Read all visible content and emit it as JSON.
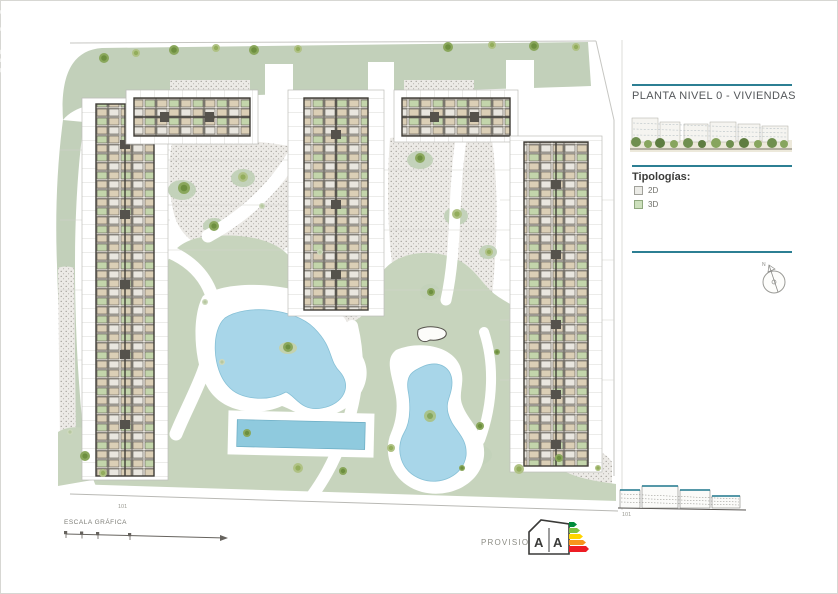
{
  "watermark": {
    "line1": "draco",
    "line2": "ea"
  },
  "panel": {
    "title": "PLANTA NIVEL 0 - VIVIENDAS",
    "legend_heading": "Tipologías:",
    "legend_items": [
      {
        "label": "2D",
        "swatch_color": "#ebebe6"
      },
      {
        "label": "3D",
        "swatch_color": "#cde0bd"
      }
    ],
    "rule_color": "#2c7f93"
  },
  "compass": {
    "label": "N"
  },
  "footer": {
    "scale_label": "ESCALA GRÁFICA",
    "left_note": "101",
    "provisional_label": "PROVISIONAL",
    "elevation_note": "101"
  },
  "energy_label": {
    "letters": [
      "A",
      "A"
    ],
    "arrow_colors": [
      "#008c3c",
      "#7fc241",
      "#ffd500",
      "#f7941d",
      "#ed1c24"
    ]
  },
  "plan_colors": {
    "lawn": "#c7d4bd",
    "top_band": "#c2d0ba",
    "stipple_base": "#eceae6",
    "stipple_dot": "#98958f",
    "pool": "#a8d6e9",
    "lap_pool": "#8fcade",
    "building_outline": "#3f3c36",
    "unit_beige": "#dbcfb6",
    "unit_green": "#c3d5ab",
    "accent_teal": "#2c7f93"
  }
}
